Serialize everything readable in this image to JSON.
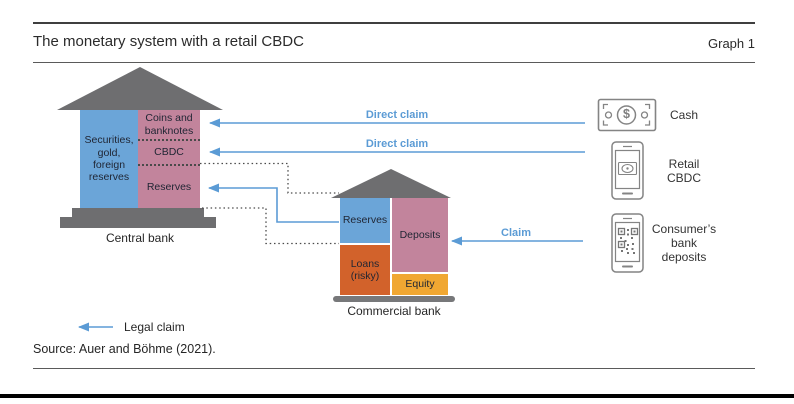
{
  "header": {
    "title": "The monetary system with a retail CBDC",
    "graph_label": "Graph 1"
  },
  "central_bank": {
    "name": "Central bank",
    "assets_box": "Securities,\ngold,\nforeign\nreserves",
    "liability_boxes": [
      "Coins and\nbanknotes",
      "CBDC",
      "Reserves"
    ]
  },
  "commercial_bank": {
    "name": "Commercial bank",
    "asset_boxes": [
      "Reserves",
      "Loans\n(risky)"
    ],
    "liability_boxes": [
      "Deposits",
      "Equity"
    ]
  },
  "claims": {
    "cash_claim": "Direct claim",
    "cbdc_claim": "Direct claim",
    "deposit_claim": "Claim"
  },
  "instruments": {
    "cash": {
      "icon": "cash-icon",
      "label": "Cash",
      "currency_glyph": "$"
    },
    "retail_cbdc": {
      "icon": "retail-cbdc-phone-icon",
      "label": "Retail\nCBDC"
    },
    "bank_deposits": {
      "icon": "qr-phone-icon",
      "label": "Consumer’s\nbank\ndeposits"
    }
  },
  "legend": {
    "label": "Legal claim"
  },
  "source": "Source: Auer and Böhme (2021).",
  "colors": {
    "asset_blue": "#6ba5d8",
    "liability_pink": "#c2849c",
    "loans_orange": "#d2622b",
    "equity_yellow": "#f0a732",
    "building_gray": "#6e6e70",
    "claim_arrow_blue": "#5b9bd5",
    "dotted_line_gray": "#4a4a4a",
    "icon_outline_gray": "#848484"
  }
}
